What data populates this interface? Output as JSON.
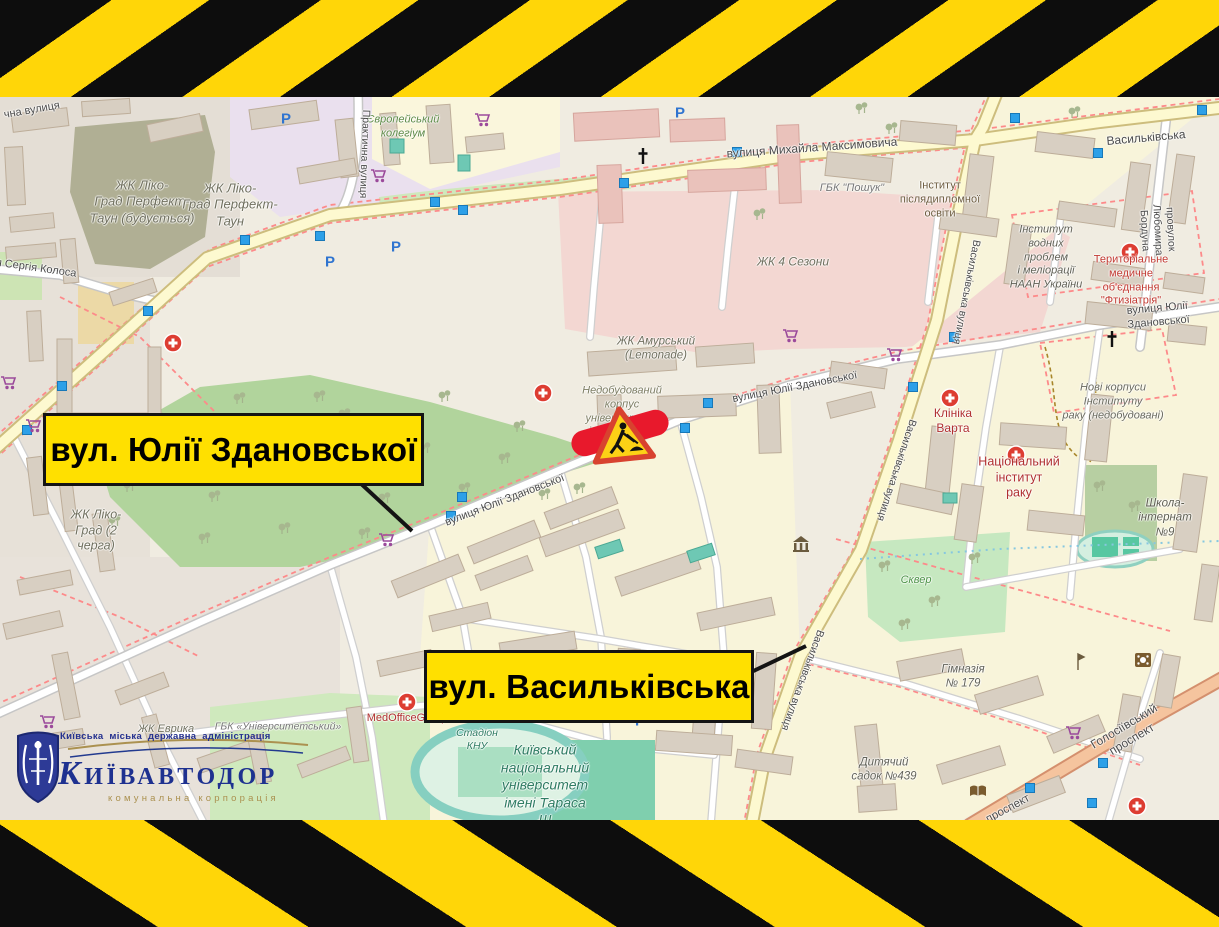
{
  "frame": {
    "stripe_yellow": "#ffd608",
    "stripe_black": "#0d0d0d",
    "callout_yellow": "#ffe000",
    "alert_red": "#e8192c"
  },
  "callouts": {
    "zdanovska": "вул. Юлії Здановської",
    "vasylkivska": "вул. Васильківська"
  },
  "logo": {
    "admin_line": "Київська міська державна адміністрація",
    "brand": "КИЇВАВТОДОР",
    "tagline": "комунальна корпорація"
  },
  "map": {
    "parking_letter": "Р",
    "labels": [
      {
        "text": "Європейський\nколегіум"
      },
      {
        "text": "чна вулиця"
      },
      {
        "text": "Практична вулиця"
      },
      {
        "text": "ЖК Ліко-\nГрад Перфект-\nТаун (будується)"
      },
      {
        "text": "ЖК Ліко-\nГрад Перфект-\nТаун"
      },
      {
        "text": "вулиця Михайла Максимовича"
      },
      {
        "text": "ГБК \"Пошук\""
      },
      {
        "text": "Інститут\nпіслядипломної\nосвіти"
      },
      {
        "text": "Васильківська"
      },
      {
        "text": "провулок Любомира Бордуна"
      },
      {
        "text": "Інститут\nводних\nпроблем\nі меліорації\nНААН України"
      },
      {
        "text": "Територіальне\nмедичне\nоб'єднання\n\"Фтизіатрія\""
      },
      {
        "text": "я Сергія Колоса"
      },
      {
        "text": "ЖК 4 Сезони"
      },
      {
        "text": "ЖК Амурський\n(Lemonade)"
      },
      {
        "text": "Недобудований\nкорпус\nуніверситету\nім. Шевченка"
      },
      {
        "text": "вулиця Юлії Здановської"
      },
      {
        "text": "вулиця Юлії Здановської"
      },
      {
        "text": "вулиця Юлії Здановської"
      },
      {
        "text": "Нові корпуси\nІнституту\nраку (недобудовані)"
      },
      {
        "text": "Клініка\nВарта"
      },
      {
        "text": "Національний\nінститут\nраку"
      },
      {
        "text": "Школа-\nінтернат\n№9"
      },
      {
        "text": "ЖК Ліко-\nГрад (2\nчерга)"
      },
      {
        "text": "Васильківська вулиця"
      },
      {
        "text": "Васильківська вулиця"
      },
      {
        "text": "Васильківська вулиця"
      },
      {
        "text": "Сквер"
      },
      {
        "text": "Гімназія\n№ 179"
      },
      {
        "text": "Дитячий\nсадок №439"
      },
      {
        "text": "Голосіївський проспект"
      },
      {
        "text": "проспект"
      },
      {
        "text": "MedOfficeGroup"
      },
      {
        "text": "Стадіон\nКНУ"
      },
      {
        "text": "Київський\nнаціональний\nуніверситет\nімені Тараса\nШ"
      },
      {
        "text": "ЖК Еврика"
      },
      {
        "text": "ГБК «Університетський»"
      }
    ]
  }
}
